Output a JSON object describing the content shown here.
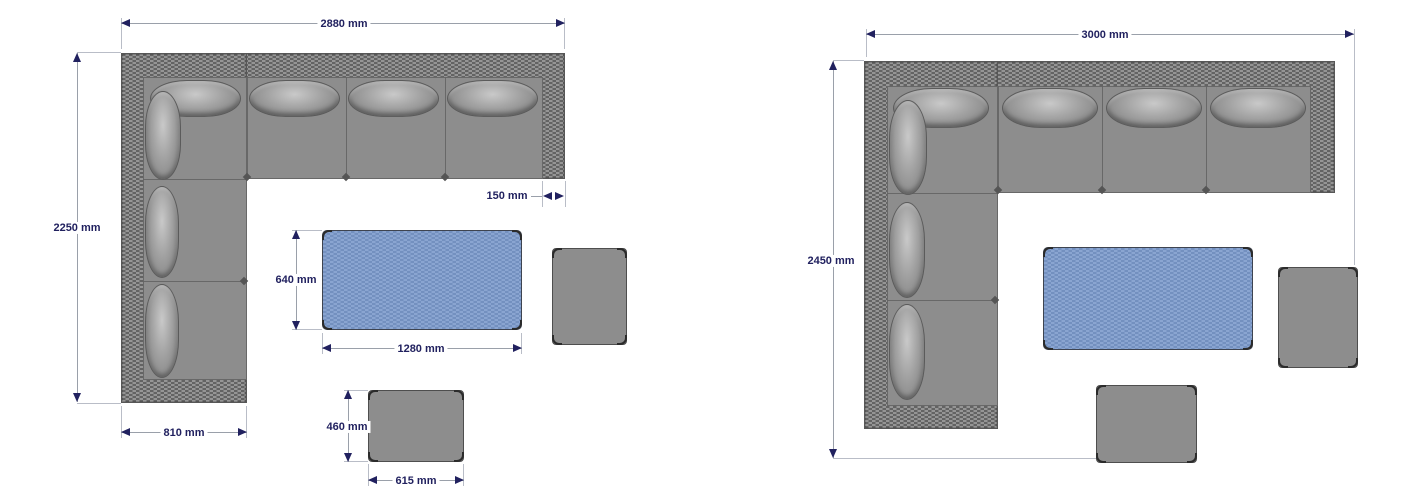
{
  "canvas": {
    "width": 1420,
    "height": 500,
    "background": "#ffffff"
  },
  "colors": {
    "dimension_text": "#21215f",
    "dimension_line": "#9aa0aa",
    "extension_line": "#b9bdc7",
    "arrow": "#21215f",
    "sofa_seat_gray": "#8d8d8d",
    "wicker_light": "#959595",
    "wicker_dark": "#636363",
    "table_blue": "#7e9ac7",
    "stool_gray": "#8d8d8d"
  },
  "diagrams": [
    {
      "side": "left",
      "labels": {
        "overall_width": "2880 mm",
        "overall_depth": "2250 mm",
        "armrest_width": "150 mm",
        "chaise_width": "810 mm",
        "table_depth": "640 mm",
        "table_width": "1280 mm",
        "footstool_depth": "460 mm",
        "footstool_width": "615 mm"
      }
    },
    {
      "side": "right",
      "labels": {
        "overall_width": "3000 mm",
        "overall_depth": "2450 mm"
      }
    }
  ]
}
